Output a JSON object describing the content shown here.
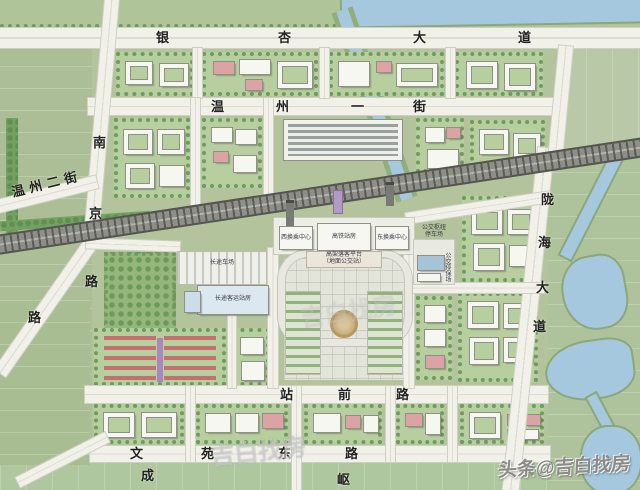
{
  "roads": {
    "yinxing_avenue": {
      "chars": [
        "银",
        "杏",
        "大",
        "道"
      ]
    },
    "wenzhou_1st_street": {
      "chars": [
        "温",
        "州",
        "一",
        "街"
      ]
    },
    "wenzhou_2nd_street": {
      "label": "温州二街"
    },
    "nanjing_road": {
      "chars": [
        "南",
        "京",
        "路"
      ],
      "extra_char": "路"
    },
    "longhai_avenue": {
      "chars": [
        "陇",
        "海",
        "大",
        "道"
      ]
    },
    "zhanqian_road": {
      "chars": [
        "站",
        "前",
        "路"
      ]
    },
    "wenyuan_east_road": {
      "chars": [
        "文",
        "苑",
        "东",
        "路"
      ]
    },
    "partial_labels": {
      "cheng": "成",
      "qu": "岖"
    }
  },
  "station": {
    "hsr_station_building": "高铁站房",
    "west_transfer_center": "西换乘中心",
    "east_transfer_center": "东换乘中心",
    "dropoff_platform_line1": "高架落客平台",
    "dropoff_platform_line2": "（地面公交站）",
    "bus_hub_line1": "公交枢纽",
    "bus_hub_line2": "停车场",
    "bus_depot": "公交停保场",
    "coach_parking": "长途车场",
    "coach_terminal": "长途客运站房"
  },
  "watermark": {
    "main": "头条@吉白找房",
    "faint": "吉白找房"
  },
  "colors": {
    "field": "#b3c49c",
    "block_green": "#b7cf9e",
    "tree": "#6d9c5e",
    "road": "#f1f1ea",
    "railway": "#8f8f89",
    "water": "#a5c8de",
    "building": "#f7f7f2",
    "pink_building": "#dba3a3",
    "red_housing": "#c4706e",
    "plaza": "#e3e5da"
  }
}
